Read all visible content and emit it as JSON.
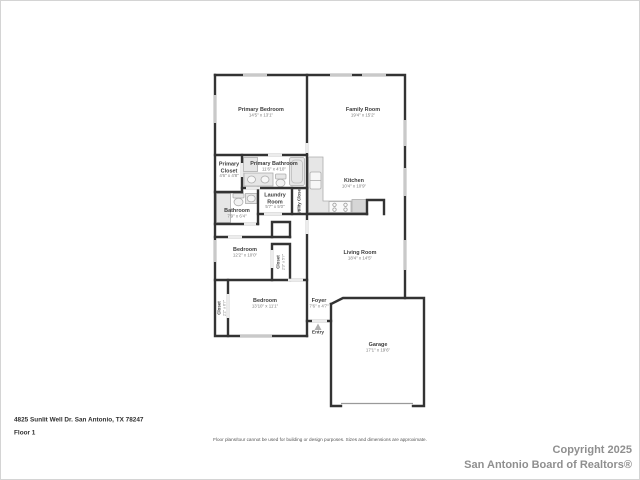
{
  "meta": {
    "kind": "residential-floor-plan"
  },
  "colors": {
    "background": "#ffffff",
    "wall": "#333333",
    "window": "#c9c9c9",
    "door_opening": "#ececec",
    "fixture_fill": "#e6e6e6",
    "fixture_stroke": "#adadad",
    "label_text": "#3c3c3c",
    "dims_text": "#7a7a7a",
    "copyright_text": "#8f8f8f"
  },
  "rooms": [
    {
      "id": "primary-bedroom",
      "name": "Primary Bedroom",
      "dims": "14'5\" x 13'1\""
    },
    {
      "id": "family-room",
      "name": "Family Room",
      "dims": "19'4\" x 15'2\""
    },
    {
      "id": "primary-closet",
      "name": "Primary Closet",
      "dims": "4'6\" x 4'8\""
    },
    {
      "id": "primary-bathroom",
      "name": "Primary Bathroom",
      "dims": "11'6\" x 4'10\""
    },
    {
      "id": "laundry-room",
      "name": "Laundry Room",
      "dims": "5'7\" x 5'0\""
    },
    {
      "id": "utility-closet",
      "name": "Utility Closet",
      "dims": ""
    },
    {
      "id": "bathroom",
      "name": "Bathroom",
      "dims": "7'9\" x 6'4\""
    },
    {
      "id": "kitchen",
      "name": "Kitchen",
      "dims": "10'4\" x 10'9\""
    },
    {
      "id": "bedroom-2",
      "name": "Bedroom",
      "dims": "12'2\" x 10'0\""
    },
    {
      "id": "closet-bedroom-2",
      "name": "Closet",
      "dims": "2'3\" x 5'7\""
    },
    {
      "id": "living-room",
      "name": "Living Room",
      "dims": "18'4\" x 14'5\""
    },
    {
      "id": "closet-bedroom-3",
      "name": "Closet",
      "dims": "2'2\" x 6'7\""
    },
    {
      "id": "bedroom-3",
      "name": "Bedroom",
      "dims": "13'10\" x 11'1\""
    },
    {
      "id": "foyer",
      "name": "Foyer",
      "dims": "7'6\" x 4'7\""
    },
    {
      "id": "entry",
      "name": "Entry",
      "dims": ""
    },
    {
      "id": "garage",
      "name": "Garage",
      "dims": "17'1\" x 19'6\""
    }
  ],
  "footer": {
    "address": "4825 Sunlit Well Dr. San Antonio, TX 78247",
    "floor_label": "Floor 1",
    "disclaimer": "Floor plans/tour cannot be used for building or design purposes. Sizes and dimensions are approximate.",
    "copyright_line1": "Copyright 2025",
    "copyright_line2": "San Antonio Board of Realtors®"
  }
}
